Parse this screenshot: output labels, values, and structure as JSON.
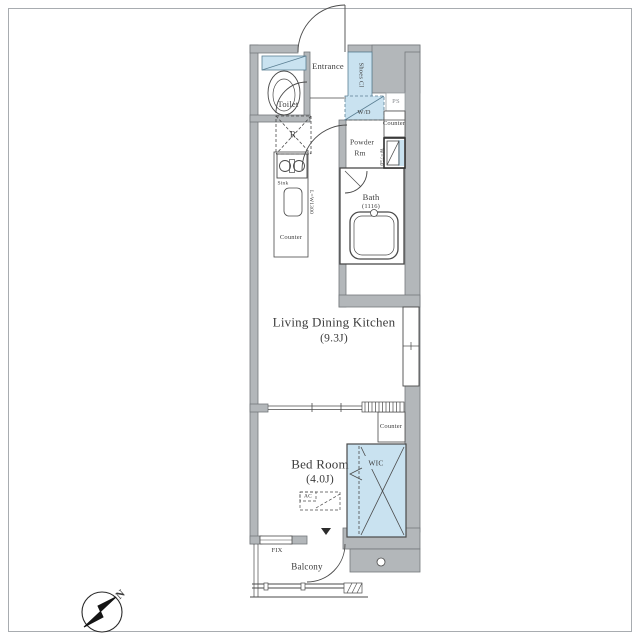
{
  "colors": {
    "wall": "#b3b7ba",
    "wall_edge": "#74787c",
    "fixture_blue": "#c9e2f0",
    "fixture_blue_edge": "#5b7f93",
    "line": "#4a4a4a",
    "text": "#3c3c3c",
    "frame": "#a8acb0"
  },
  "compass": {
    "north_label": "N"
  },
  "rooms": {
    "toilet": {
      "label": "Toilet"
    },
    "entrance": {
      "label": "Entrance"
    },
    "shoes_closet": {
      "label": "Shoes Cl"
    },
    "washer_dryer": {
      "label": "W/D"
    },
    "pipe_space": {
      "label": "PS"
    },
    "powder_counter": {
      "label": "Counter"
    },
    "powder_room": {
      "line1": "Powder",
      "line2": "Rm"
    },
    "vanity_dim": {
      "label": "W=750"
    },
    "bath": {
      "label": "Bath",
      "size": "(1116)"
    },
    "refrigerator": {
      "label": "R"
    },
    "kitchen": {
      "sink_label": "Sink",
      "dim_label": "L=W1300",
      "counter_label": "Counter"
    },
    "ldk": {
      "label": "Living Dining Kitchen",
      "size": "(9.3J)"
    },
    "bedroom": {
      "label": "Bed Room",
      "size": "(4.0J)"
    },
    "wic": {
      "label": "WIC"
    },
    "bedroom_counter": {
      "label": "Counter"
    },
    "ac": {
      "label": "AC"
    },
    "fix_window": {
      "label": "FIX"
    },
    "balcony": {
      "label": "Balcony"
    }
  }
}
